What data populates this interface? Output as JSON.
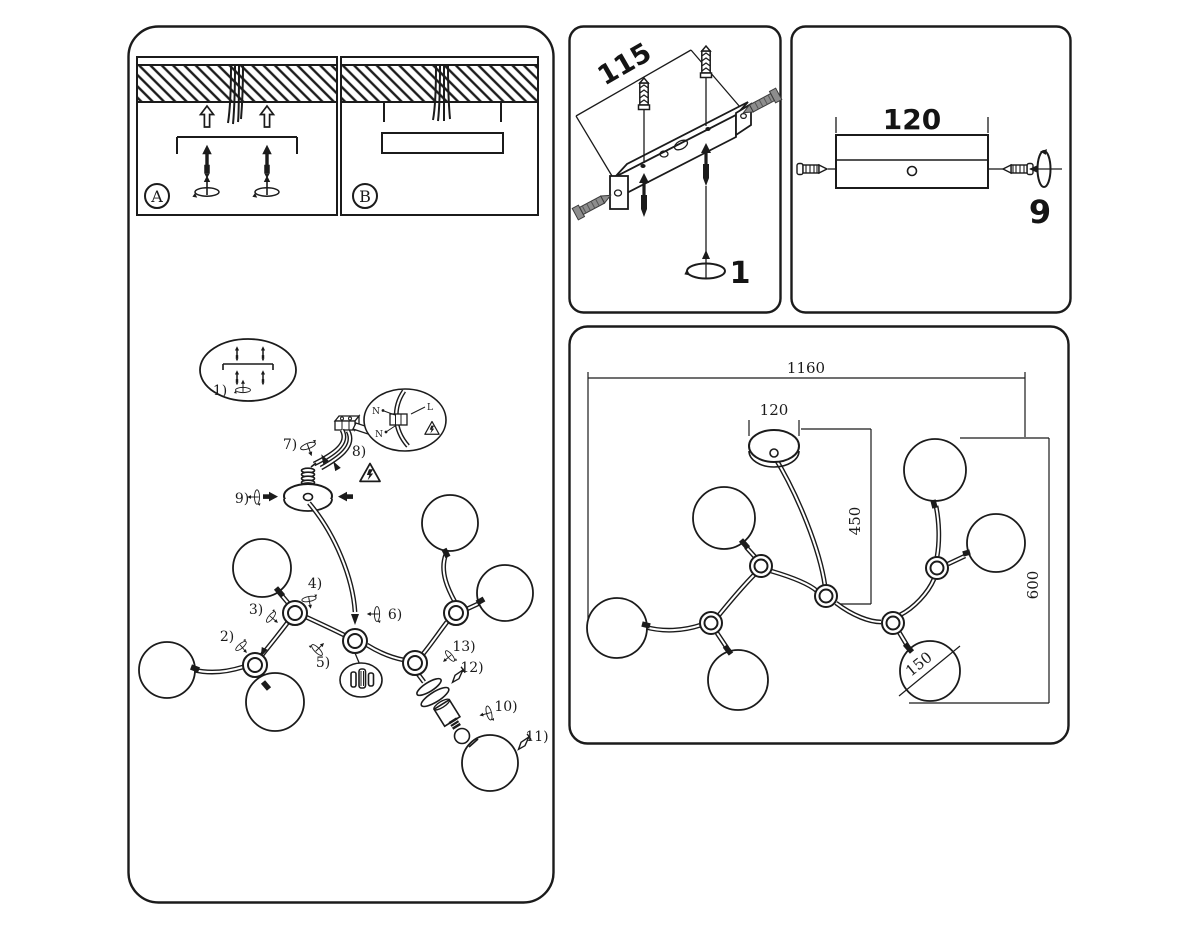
{
  "install_options": {
    "option_a": "A",
    "option_b": "B"
  },
  "assembly_steps": {
    "s1": "1)",
    "s2": "2)",
    "s3": "3)",
    "s4": "4)",
    "s5": "5)",
    "s6": "6)",
    "s7": "7)",
    "s8": "8)",
    "s9": "9)",
    "s10": "10)",
    "s11": "11)",
    "s12": "12)",
    "s13": "13)"
  },
  "wiring_labels": {
    "neutral": "N",
    "live": "L"
  },
  "mounting_bracket_panel": {
    "length_dimension": "115",
    "step_number": "1"
  },
  "canopy_side_panel": {
    "width_dimension": "120",
    "step_number": "9"
  },
  "plan_view_panel": {
    "overall_width": "1160",
    "canopy_diameter": "120",
    "canopy_center_offset": "450",
    "overall_depth": "600",
    "globe_diameter": "150"
  }
}
